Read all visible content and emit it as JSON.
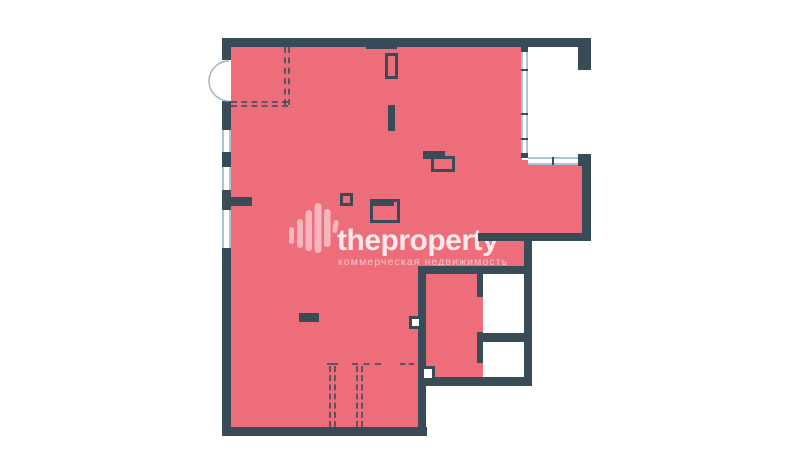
{
  "watermark": {
    "brand": "theproperty",
    "tagline": "коммерческая недвижимость"
  },
  "colors": {
    "background": "#ffffff",
    "floor_fill": "#ee6d7b",
    "wall": "#3a4b58",
    "window": "#aac7d9",
    "dash": "rgba(60,76,88,0.8)",
    "door_stroke": "#a5b0b8",
    "logo_bar": "rgba(255,255,255,0.5)",
    "brand_text": "rgba(255,255,255,0.85)",
    "tagline_text": "rgba(255,255,255,0.6)"
  },
  "plan": {
    "type": "floor-plan",
    "highlighted_area_color": "#ee6d7b",
    "features": [
      "entrance-double-door",
      "left-window-band",
      "right-window-band",
      "loggia-niche",
      "two-sanitary-rooms",
      "dashed-partition-marks"
    ]
  }
}
